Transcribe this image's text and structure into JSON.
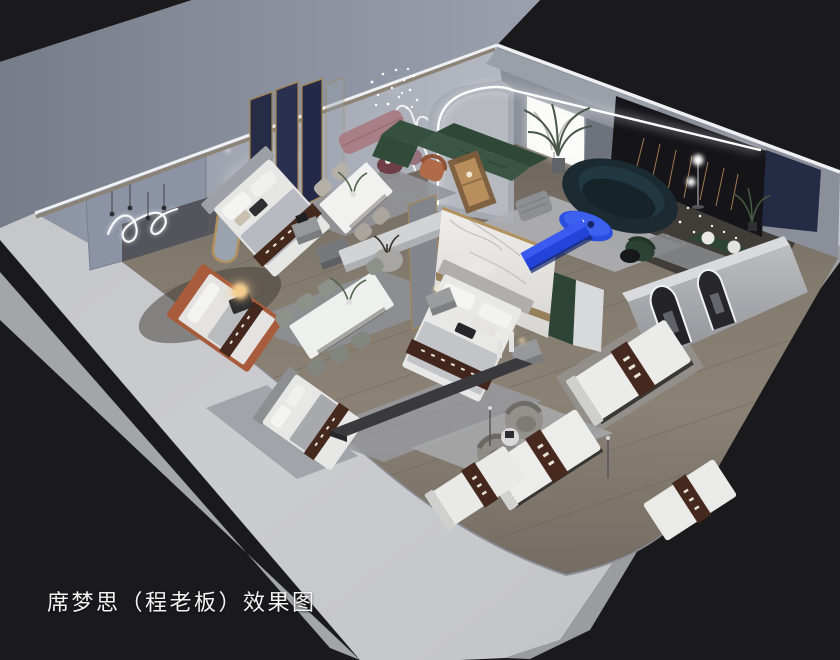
{
  "meta": {
    "kind": "3d-interior-render",
    "view": "isometric cutaway (dollhouse) of a mattress showroom interior",
    "canvas": {
      "width": 840,
      "height": 660
    }
  },
  "caption": {
    "text": "席梦思（程老板）效果图"
  },
  "palette": {
    "background": "#1a1a1c",
    "outer_wall_band": "#c9cacd",
    "exterior_wall_shadow": "#868c98",
    "wall_interior": "#a6aab4",
    "wall_fabric_panel": "#8b93a4",
    "floor_wood": "#847a6e",
    "dark_feature_wall": "#141419",
    "navy_panel": "#252b45",
    "gold_trim": "#a5854f",
    "led_glow": "#ffffff",
    "sofa_green": "#32503e",
    "sofa_teal_dark": "#1b2b31",
    "accent_blue": "#2b4de0",
    "bench_pink": "#a87f86",
    "armchair_terracotta": "#b06a48",
    "mattress_white": "#ebebe9",
    "runner_brown": "#46291e",
    "rug_gray": "#a8a9ac"
  },
  "scene": {
    "rooms": [
      "bedroom-display-left",
      "dining-display-front",
      "master-bedroom-display",
      "living-room-display",
      "dark-gallery-room",
      "kids-bedroom-display",
      "mattress-gallery",
      "arched-corridor"
    ],
    "furniture": [
      "upholstered-beds",
      "mattress-display-beds",
      "dining-table-sets",
      "green-sectional-sofa",
      "curved-teal-sofa",
      "blue-coffee-table",
      "blue-tv-console",
      "pink-bench",
      "poufs",
      "terracotta-armchair",
      "gray-tub-chairs",
      "nightstands",
      "sideboard-bench",
      "media-console",
      "marble-partition",
      "navy-screen-partition",
      "arched-floor-mirrors",
      "display-cabinet",
      "green-wall-bench"
    ],
    "lighting": [
      "led-arch-strip",
      "crystal-chandelier",
      "string-light-curtain",
      "wall-squiggle-neon",
      "pendant-drops",
      "glow-orb-table-lamp",
      "globe-floor-lamp",
      "backlit-light-panel"
    ]
  }
}
